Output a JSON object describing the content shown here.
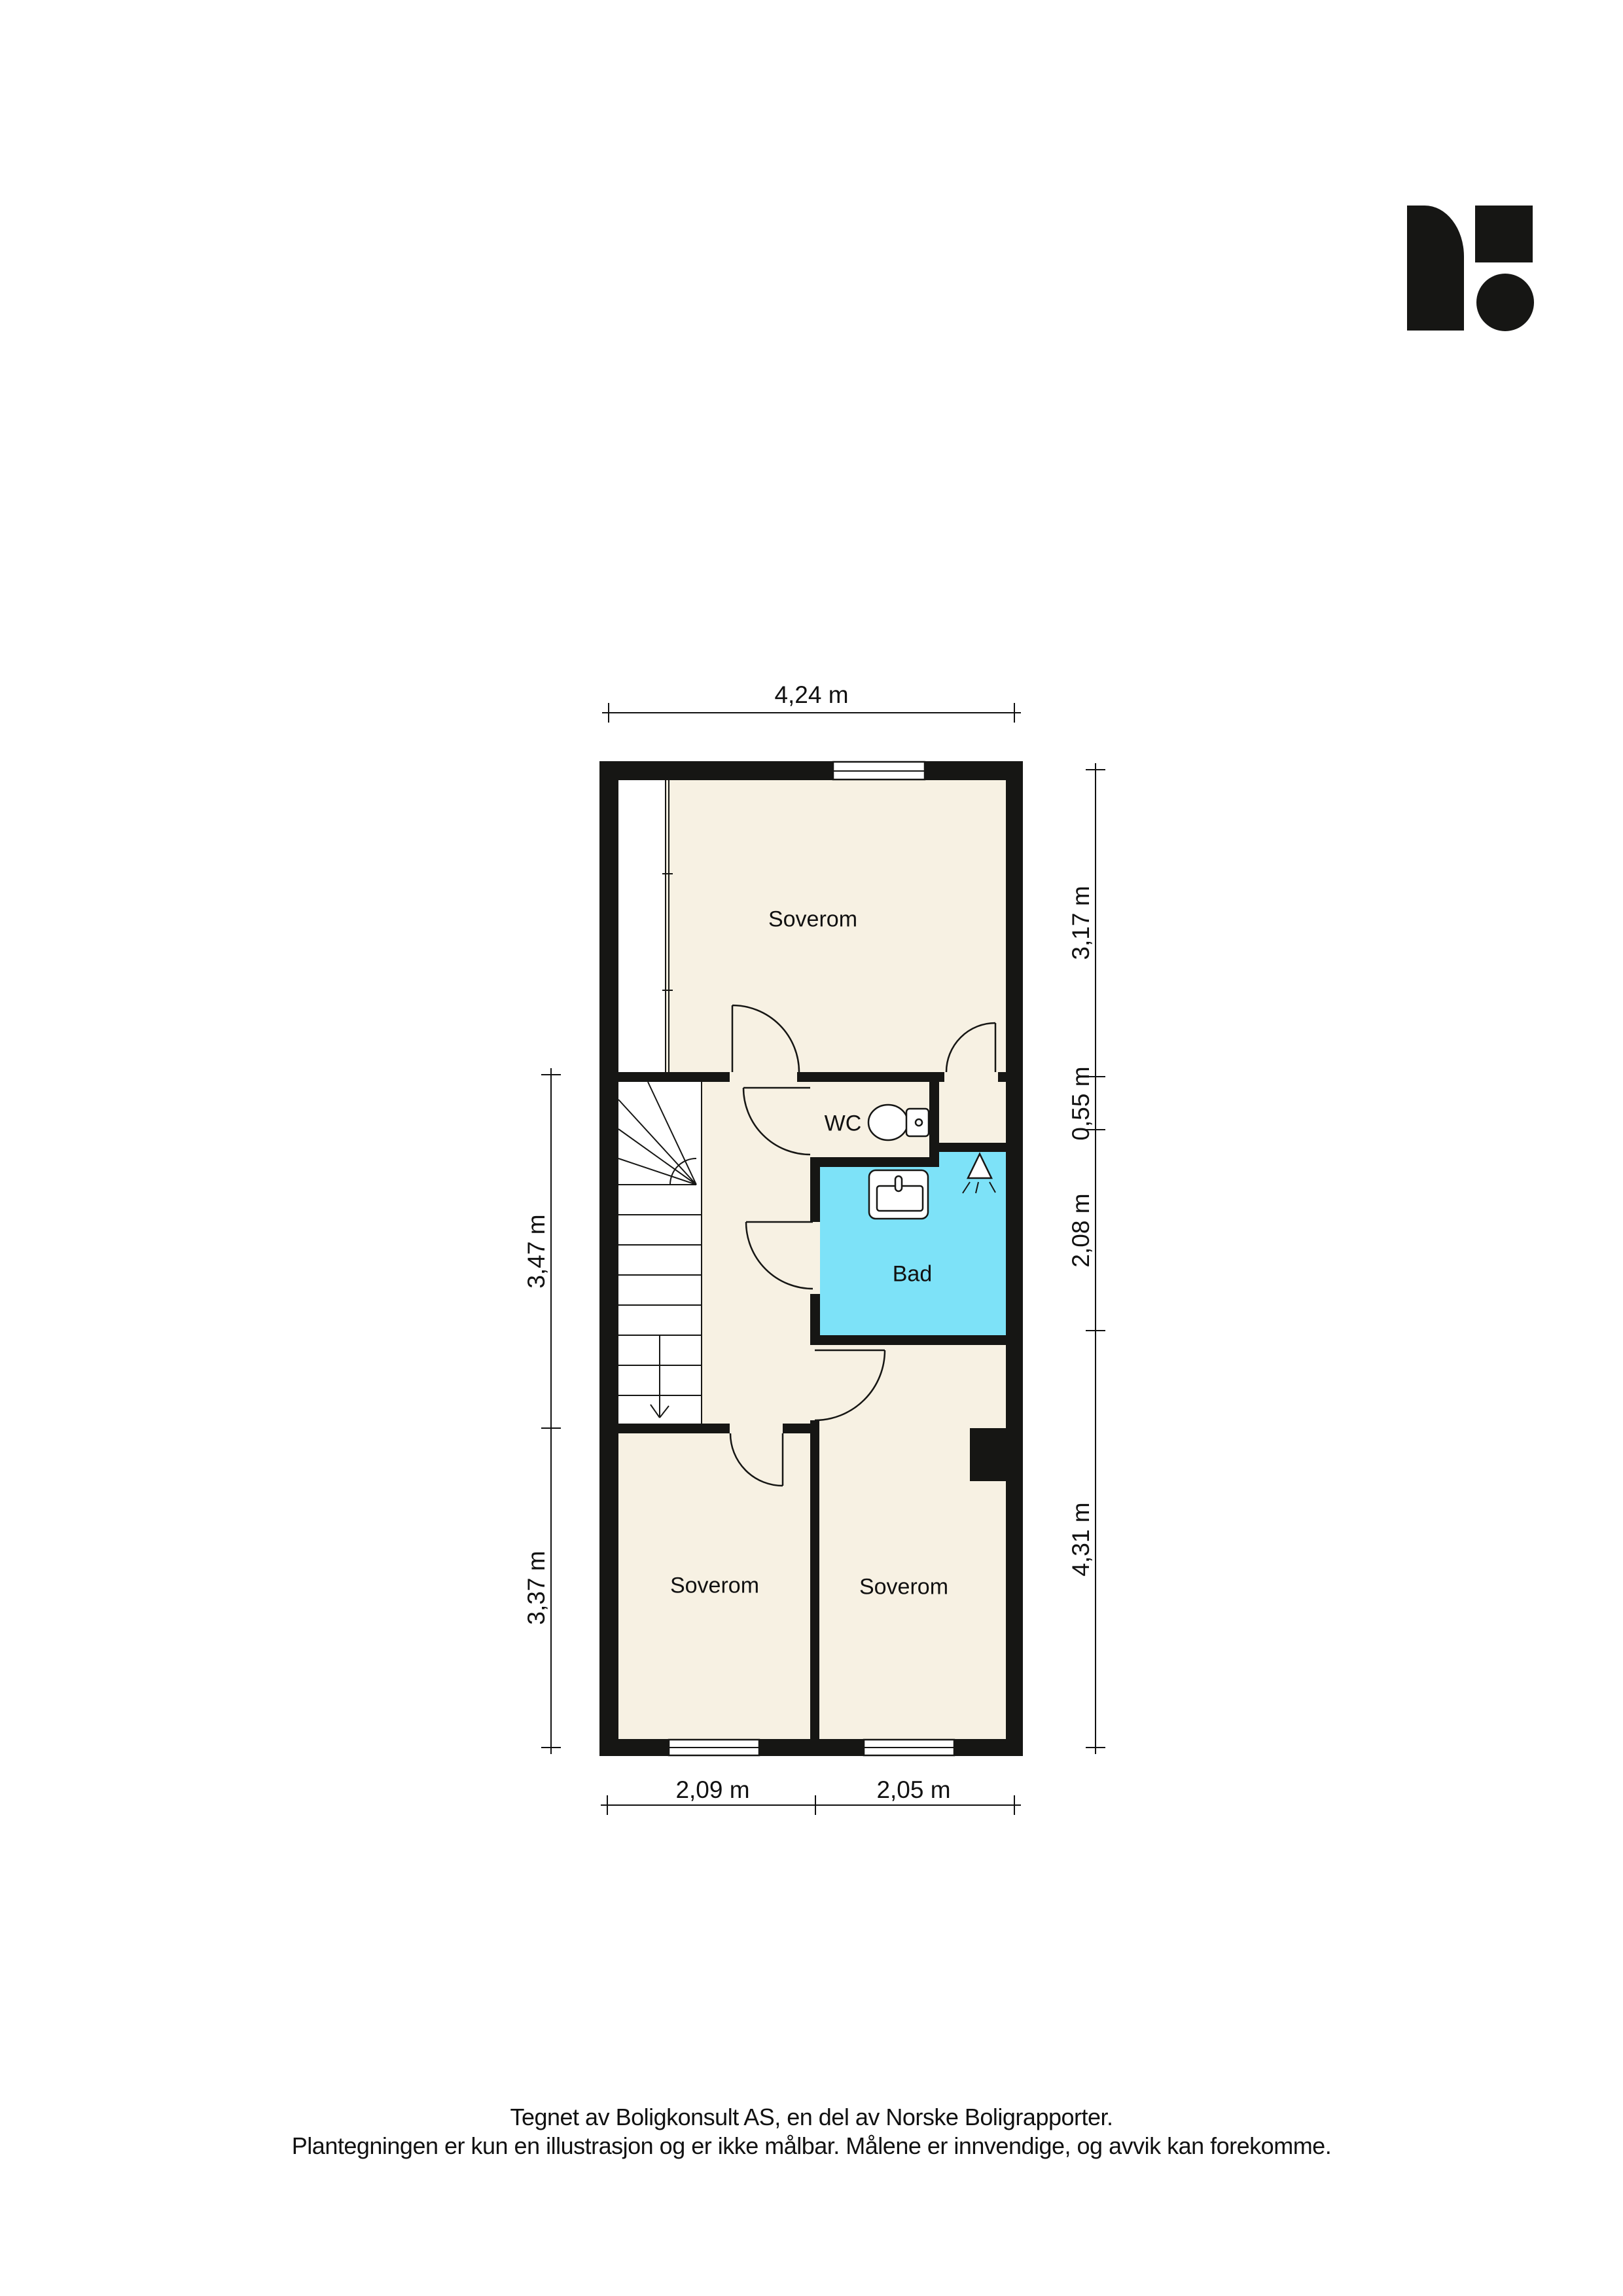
{
  "colors": {
    "wall": "#161614",
    "floor": "#F7F1E3",
    "wet": "#7DE2F8",
    "ink": "#111111",
    "bg": "#FFFFFF"
  },
  "rooms": {
    "bedroom_top": {
      "label": "Soverom"
    },
    "wc": {
      "label": "WC"
    },
    "bath": {
      "label": "Bad"
    },
    "bedroom_bottom_left": {
      "label": "Soverom"
    },
    "bedroom_bottom_right": {
      "label": "Soverom"
    }
  },
  "dimensions": {
    "top": "4,24 m",
    "right": [
      "3,17 m",
      "0,55 m",
      "2,08 m",
      "4,31 m"
    ],
    "left": [
      "3,47 m",
      "3,37 m"
    ],
    "bottom": [
      "2,09 m",
      "2,05 m"
    ]
  },
  "footer": {
    "line1": "Tegnet av Boligkonsult AS, en del av Norske Boligrapporter.",
    "line2": "Plantegningen er kun en illustrasjon og er ikke målbar. Målene er innvendige, og avvik kan forekomme."
  }
}
